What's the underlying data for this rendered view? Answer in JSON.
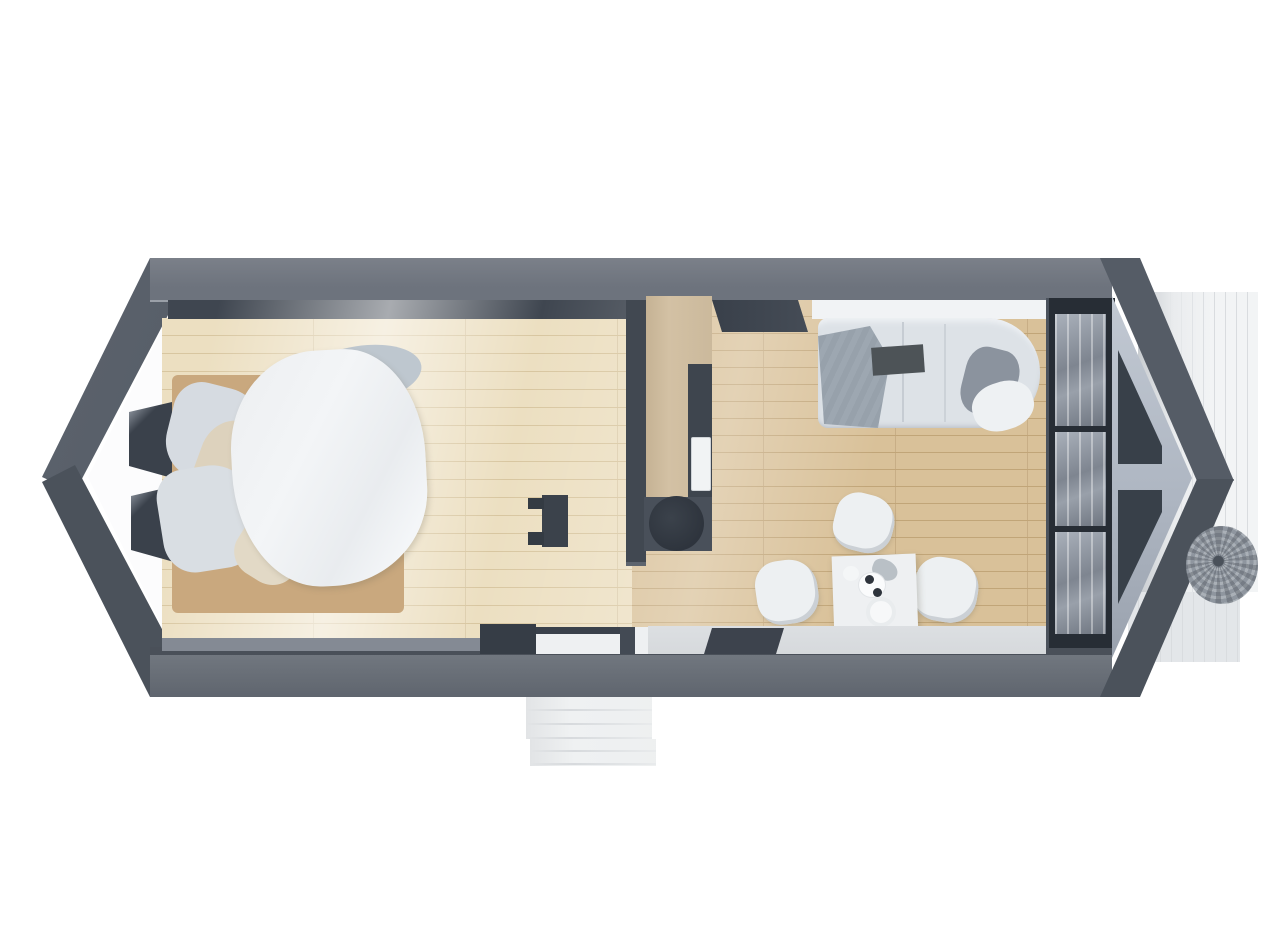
{
  "scene": {
    "description": "Top-down 3D render of a tiny house floor plan with pointed gable ends, entry steps at the front and a plank deck on the right side",
    "view": "top-down-3d-render",
    "background": "#ffffff"
  },
  "rooms": [
    {
      "id": "bedroom",
      "label": "Bedroom"
    },
    {
      "id": "kitchen",
      "label": "Kitchenette"
    },
    {
      "id": "living",
      "label": "Living / dining area"
    }
  ],
  "objects": {
    "bedroom": [
      "double bed with white duvet",
      "gray and beige pillows",
      "wood bed frame",
      "small dark wall desk",
      "two niche windows in left gable wall"
    ],
    "kitchen": [
      "tall wood cabinet",
      "dark counter strip with white sink",
      "dark base unit with round hob"
    ],
    "living": [
      "light gray sofa with gray throw blanket",
      "dark tray on sofa",
      "rounded lounge end with dark cushion",
      "square white dining table",
      "three white shell chairs",
      "plates and cups on table"
    ],
    "exterior": [
      "white entry steps at front",
      "right side plank deck",
      "round gray wicker chair on deck",
      "two triangular gable windows",
      "band of three floor-to-ceiling windows",
      "open door leaf at rear wall",
      "dark door mat",
      "white door threshold"
    ]
  },
  "palette": {
    "bg": "#ffffff",
    "roof_dark": "#555c66",
    "roof_darker": "#4b525b",
    "wall_band": "#6d737d",
    "wall_inner": "#3f4650",
    "bottom_line": "#4a5059",
    "inner_strip": "#848a94",
    "floor_bed": "#ecdfc1",
    "floor_bed_line": "#d8c6a0",
    "floor_living": "#d9c199",
    "floor_living_line": "#c1a578",
    "cabinet": "#d3c1a4",
    "counter": "#3e454e",
    "sink": "#f1f3f4",
    "stove_base": "#49505a",
    "stove_top": "#2e343d",
    "partition": "#414851",
    "niche": "#3a414b",
    "bed_wood": "#c9a87e",
    "pillow_gray": "#d6dbe1",
    "pillow_beige": "#ddd2bd",
    "sheet_gray": "#bec7cf",
    "duvet": "#f3f5f7",
    "desk": "#3b424b",
    "sofa": "#dde2e7",
    "sofa_light": "#f1f3f5",
    "blanket": "#9da7b1",
    "cushion_dark": "#8b939e",
    "tray": "#4d5357",
    "table": "#eef0f2",
    "chair": "#edf0f2",
    "entry_strip": "#d6d9dc",
    "mat": "#3d434d",
    "threshold": "#eef0f2",
    "frame": "#272d35",
    "glass_a": "#aab1bb",
    "glass_b": "#6e7580",
    "gable_face": "#aeb6c2",
    "tri_window": "#384049",
    "deck": "#f2f4f5",
    "deck_line": "#d9dcdf",
    "deck_shade": "#c9cdd1",
    "step": "#eff1f2",
    "step_line": "#d7dadd",
    "wicker": "#8f969f",
    "wicker_light": "#aab0b7"
  }
}
